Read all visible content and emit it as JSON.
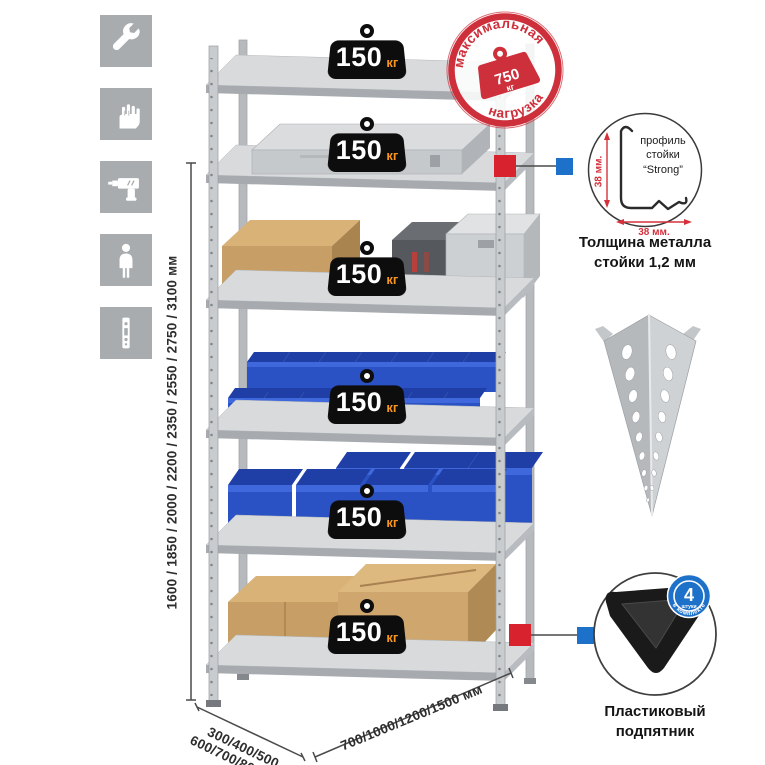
{
  "colors": {
    "accent_red": "#d8232e",
    "accent_blue": "#1d71c9",
    "stamp_red": "#cd2f3b",
    "unit_orange": "#f7941e",
    "badge_black": "#0d0d0d",
    "bin_blue": "#2a52c4",
    "metal_gray": "#c9ccce",
    "icon_gray": "#a8acaf"
  },
  "left_toolbar": {
    "icons": [
      {
        "name": "wrench"
      },
      {
        "name": "gloves"
      },
      {
        "name": "drill"
      },
      {
        "name": "person"
      },
      {
        "name": "rack-post"
      }
    ]
  },
  "height_dimension": {
    "label": "1600 / 1850 / 2000 / 2200 / 2350 / 2550 / 2750 / 3100 мм"
  },
  "depth_dimension": {
    "line1": "300/400/500",
    "line2": "600/700/800 мм"
  },
  "width_dimension": {
    "label": "700/1000/1200/1500 мм"
  },
  "rack": {
    "badges": [
      {
        "value": "150",
        "unit": "кг"
      },
      {
        "value": "150",
        "unit": "кг"
      },
      {
        "value": "150",
        "unit": "кг"
      },
      {
        "value": "150",
        "unit": "кг"
      },
      {
        "value": "150",
        "unit": "кг"
      },
      {
        "value": "150",
        "unit": "кг"
      }
    ]
  },
  "max_load_stamp": {
    "arc_top": "максимальная",
    "arc_bottom": "нагрузка",
    "value": "750",
    "unit": "кг"
  },
  "profile_detail": {
    "label": "профиль стойки “Strong”",
    "vertical_dim": "38 мм.",
    "horizontal_dim": "38 мм.",
    "caption": "Толщина металла стойки 1,2 мм"
  },
  "foot_detail": {
    "badge_value": "4",
    "badge_subtext": "штуки",
    "badge_arc": "в комплекте",
    "caption": "Пластиковый подпятник"
  }
}
